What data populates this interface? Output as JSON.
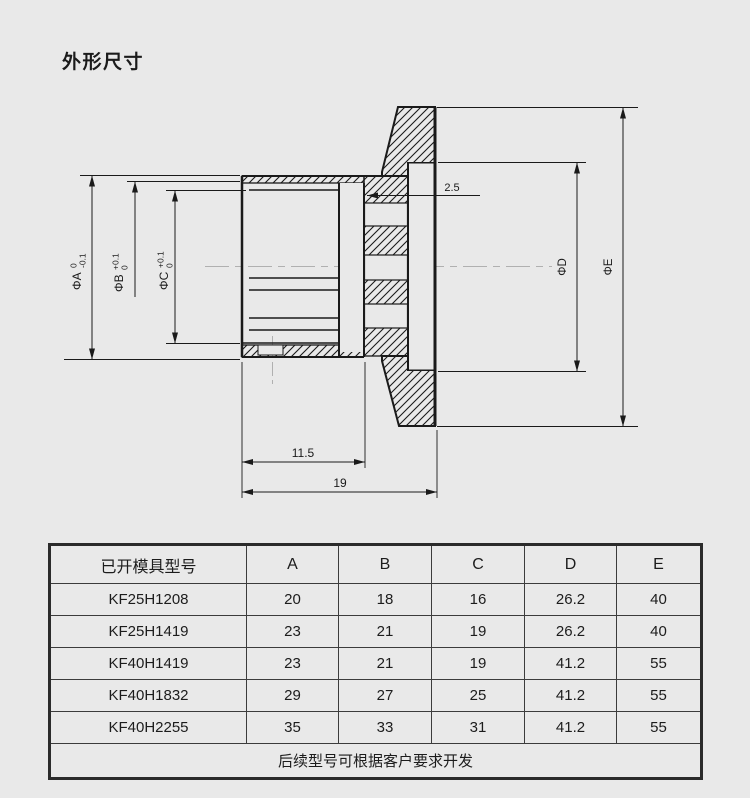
{
  "page": {
    "title": "外形尺寸",
    "background": "#e9e9e9"
  },
  "drawing": {
    "dimensions": {
      "dim_a": {
        "label": "ΦA",
        "upper_tol": "0",
        "lower_tol": "-0.1"
      },
      "dim_b": {
        "label": "ΦB",
        "upper_tol": "+0.1",
        "lower_tol": "0"
      },
      "dim_c": {
        "label": "ΦC",
        "upper_tol": "+0.1",
        "lower_tol": "0"
      },
      "dim_d": {
        "label": "ΦD"
      },
      "dim_e": {
        "label": "ΦE"
      },
      "groove_width": "2.5",
      "hub_length": "11.5",
      "total_length": "19"
    },
    "colors": {
      "line": "#1a1a1a",
      "centerline": "#b0b0b0"
    }
  },
  "table": {
    "headers": [
      "已开模具型号",
      "A",
      "B",
      "C",
      "D",
      "E"
    ],
    "rows": [
      {
        "model": "KF25H1208",
        "values": [
          "20",
          "18",
          "16",
          "26.2",
          "40"
        ]
      },
      {
        "model": "KF25H1419",
        "values": [
          "23",
          "21",
          "19",
          "26.2",
          "40"
        ]
      },
      {
        "model": "KF40H1419",
        "values": [
          "23",
          "21",
          "19",
          "41.2",
          "55"
        ]
      },
      {
        "model": "KF40H1832",
        "values": [
          "29",
          "27",
          "25",
          "41.2",
          "55"
        ]
      },
      {
        "model": "KF40H2255",
        "values": [
          "35",
          "33",
          "31",
          "41.2",
          "55"
        ]
      }
    ],
    "footer": "后续型号可根据客户要求开发"
  }
}
